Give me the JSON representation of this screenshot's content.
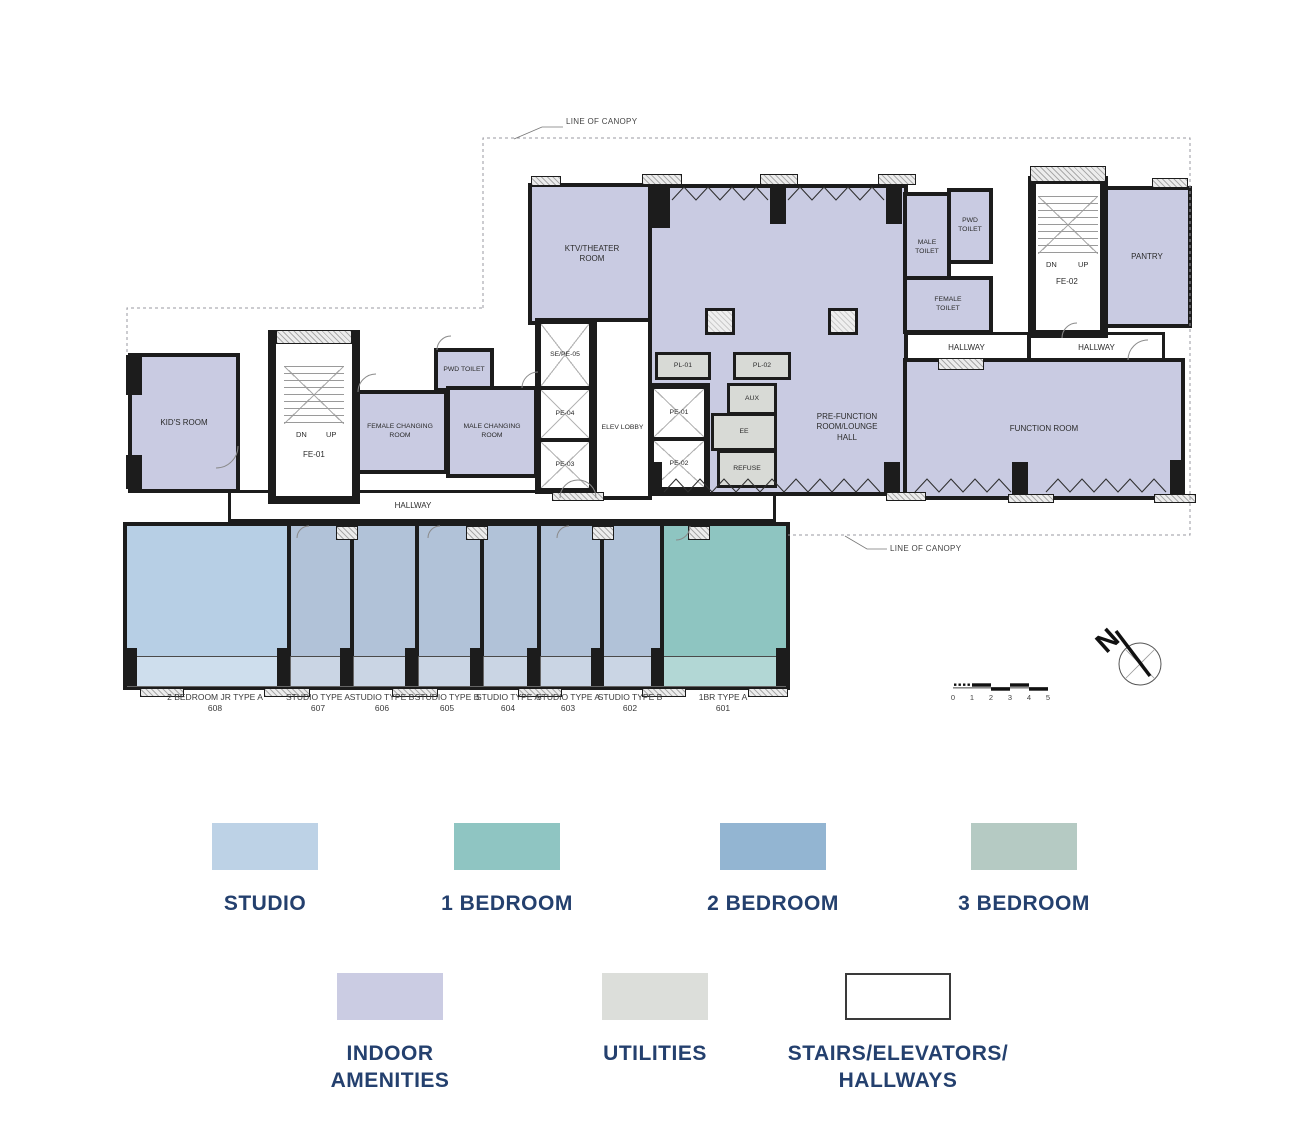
{
  "plan": {
    "canopy": {
      "top_label": "LINE OF CANOPY",
      "bottom_label": "LINE OF CANOPY"
    },
    "rooms": {
      "ktv": "KTV/THEATER\nROOM",
      "pwd_toilet_top": "PWD\nTOILET",
      "male_toilet": "MALE\nTOILET",
      "female_toilet": "FEMALE\nTOILET",
      "pantry": "PANTRY",
      "pre_function": "PRE-FUNCTION\nROOM/LOUNGE\nHALL",
      "function_room": "FUNCTION ROOM",
      "kids_room": "KID'S ROOM",
      "female_changing": "FEMALE CHANGING\nROOM",
      "male_changing": "MALE CHANGING\nROOM",
      "pwd_toilet_left": "PWD TOILET",
      "elev_lobby": "ELEV LOBBY",
      "se_pe05": "SE/PE-05",
      "pe04": "PE-04",
      "pe03": "PE-03",
      "pe01": "PE-01",
      "pe02": "PE-02",
      "pl01": "PL-01",
      "pl02": "PL-02",
      "aux": "AUX",
      "ee": "EE",
      "refuse": "REFUSE",
      "hallway_left": "HALLWAY",
      "hallway_mid": "HALLWAY",
      "hallway_right": "HALLWAY"
    },
    "stairs": {
      "fe01": {
        "name": "FE-01",
        "dn": "DN",
        "up": "UP"
      },
      "fe02": {
        "name": "FE-02",
        "dn": "DN",
        "up": "UP"
      }
    },
    "units": [
      {
        "name": "2 BEDROOM JR TYPE A",
        "number": "608"
      },
      {
        "name": "STUDIO TYPE A",
        "number": "607"
      },
      {
        "name": "STUDIO TYPE B",
        "number": "606"
      },
      {
        "name": "STUDIO TYPE B",
        "number": "605"
      },
      {
        "name": "STUDIO TYPE A",
        "number": "604"
      },
      {
        "name": "STUDIO TYPE A",
        "number": "603"
      },
      {
        "name": "STUDIO TYPE B",
        "number": "602"
      },
      {
        "name": "1BR TYPE A",
        "number": "601"
      }
    ],
    "compass": {
      "label": "N"
    },
    "scale_bar": {
      "ticks": [
        "0",
        "1",
        "2",
        "3",
        "4",
        "5"
      ]
    }
  },
  "legend": {
    "row1": [
      {
        "label": "STUDIO",
        "color": "#bdd2e6"
      },
      {
        "label": "1 BEDROOM",
        "color": "#8fc5c2"
      },
      {
        "label": "2 BEDROOM",
        "color": "#93b5d2"
      },
      {
        "label": "3 BEDROOM",
        "color": "#b5cac3"
      }
    ],
    "row2": [
      {
        "label": "INDOOR\nAMENITIES",
        "color": "#cbcce3"
      },
      {
        "label": "UTILITIES",
        "color": "#dcdeda"
      },
      {
        "label": "STAIRS/ELEVATORS/\nHALLWAYS",
        "color": "#ffffff"
      }
    ]
  },
  "colors": {
    "wall": "#1c1c1c",
    "text_navy": "#24406e",
    "amenity_fill": "#c9cbe2",
    "utility_fill": "#d8dad6",
    "studio_fill": "#b1c2d8",
    "two_bedroom_jr_fill": "#b7cfe5",
    "one_bedroom_fill": "#8ec5c1"
  }
}
